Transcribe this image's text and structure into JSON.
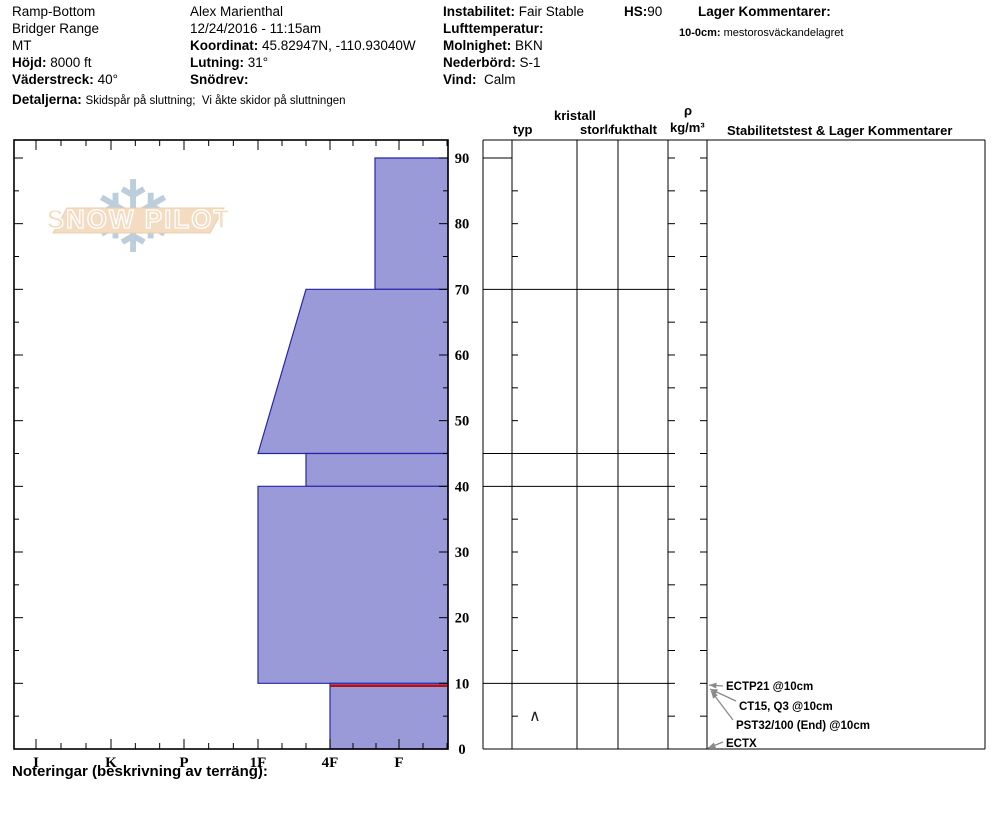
{
  "header": {
    "location": {
      "name": "Ramp-Bottom",
      "range": "Bridger Range",
      "state": "MT"
    },
    "elevation": {
      "label": "Höjd:",
      "value": "8000 ft"
    },
    "aspect": {
      "label": "Väderstreck:",
      "value": "40°"
    },
    "details": {
      "label": "Detaljerna:",
      "value": "Skidspår på sluttning;  Vi åkte skidor på sluttningen"
    },
    "observer": {
      "name": "Alex Marienthal",
      "datetime": "12/24/2016 - 11:15am"
    },
    "coordinates": {
      "label": "Koordinat:",
      "value": "45.82947N, -110.93040W"
    },
    "slope": {
      "label": "Lutning:",
      "value": "31°"
    },
    "drifting": {
      "label": "Snödrev:",
      "value": ""
    },
    "instability": {
      "label": "Instabilitet:",
      "value": "Fair Stable"
    },
    "air_temp": {
      "label": "Lufttemperatur:",
      "value": ""
    },
    "sky": {
      "label": "Molnighet:",
      "value": "BKN"
    },
    "precip": {
      "label": "Nederbörd:",
      "value": "S-1"
    },
    "wind": {
      "label": "Vind:",
      "value": "Calm"
    },
    "hs": {
      "label": "HS:",
      "value": "90"
    },
    "layer_comments": {
      "title": "Lager Kommentarer:",
      "entry_label": "10-0cm:",
      "entry_value": "mestorosväckandelagret"
    }
  },
  "logo": {
    "text": "SNOW PILOT",
    "snowflake": "❄",
    "banner_fill": "#f4dcc2",
    "banner_stroke": "#e9cfab",
    "flake_color": "#bccddb"
  },
  "columns": {
    "typ": "typ",
    "kristall": "kristall",
    "storlek": "storlek",
    "fukthalt": "fukthalt",
    "rho": "ρ",
    "rho_units": "kg/m³",
    "stability": "Stabilitetstest & Lager Kommentarer"
  },
  "footer": {
    "notes_label": "Noteringar (beskrivning av terräng):"
  },
  "chart_data": {
    "type": "bar",
    "subtype": "snow-hardness-profile",
    "title": "",
    "depth_axis": {
      "unit": "cm",
      "min": 0,
      "max": 90,
      "ticks": [
        0,
        10,
        20,
        30,
        40,
        50,
        60,
        70,
        80,
        90
      ]
    },
    "hardness_axis": {
      "categories": [
        "I",
        "K",
        "P",
        "1F",
        "4F",
        "F"
      ],
      "note": "hand hardness, harder to the left"
    },
    "total_depth_hs": 90,
    "layers": [
      {
        "top": 90,
        "bottom": 70,
        "hardness_top": "F+",
        "hardness_bottom": "F+"
      },
      {
        "top": 70,
        "bottom": 45,
        "hardness_top": "4F+",
        "hardness_bottom": "1F"
      },
      {
        "top": 45,
        "bottom": 40,
        "hardness_top": "4F+",
        "hardness_bottom": "4F+"
      },
      {
        "top": 40,
        "bottom": 10,
        "hardness_top": "1F",
        "hardness_bottom": "1F"
      },
      {
        "top": 10,
        "bottom": 0,
        "hardness_top": "4F",
        "hardness_bottom": "4F",
        "grain_symbol": "∧",
        "grain_type": "depth hoar",
        "flagged": true
      }
    ],
    "layer_boundaries": [
      90,
      70,
      45,
      40,
      10,
      0
    ],
    "annotations": [
      {
        "label": "ECTP21 @10cm",
        "depth": 10
      },
      {
        "label": "CT15, Q3 @10cm",
        "depth": 10
      },
      {
        "label": "PST32/100 (End) @10cm",
        "depth": 10
      },
      {
        "label": "ECTX",
        "depth": 0
      }
    ],
    "colors": {
      "layer_fill": "#9a9ad8",
      "layer_stroke": "#2626aa",
      "flag_line": "#b51111",
      "grid": "#000000",
      "arrow": "#8a8a8a"
    }
  }
}
